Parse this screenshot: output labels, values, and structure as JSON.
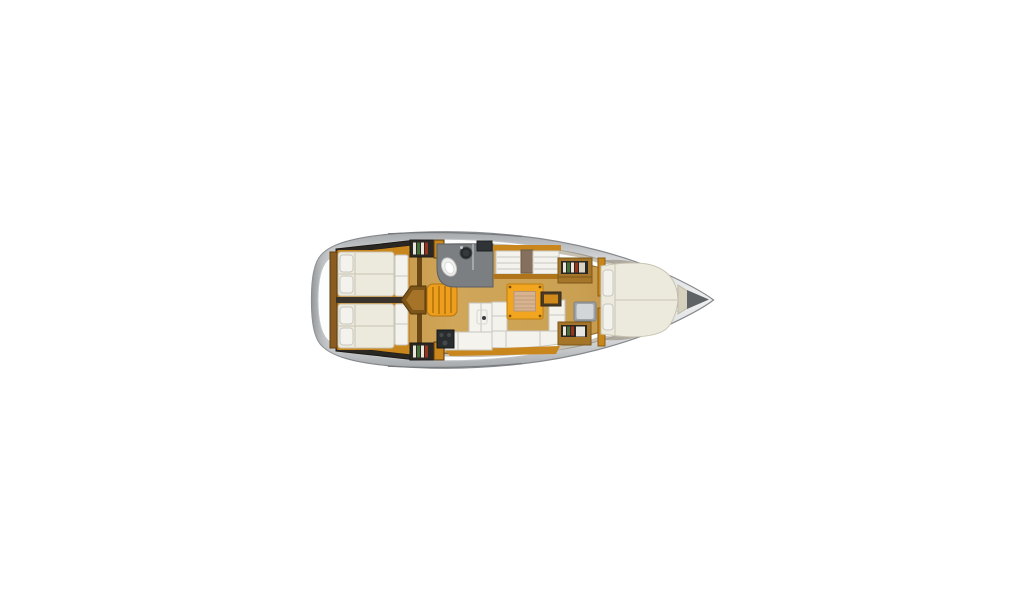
{
  "figure": {
    "kind": "yacht-interior-floor-plan",
    "orientation": "bow-right",
    "background": "#ffffff"
  },
  "colors": {
    "hull_edge": "#85898c",
    "hull_top": "#a6a9ac",
    "hull_mid": "#edeeee",
    "deck_white": "#fcfdfd",
    "deck_line": "#c2c5c7",
    "sheer_line": "#74787b",
    "floor_wood_edge": "#c1913f",
    "floor_wood_mid": "#d0a65a",
    "floor_wood_line": "#8a6526",
    "cabinet_orange": "#ed9e1d",
    "cabinet_orange_dark": "#c8861c",
    "trim_brown": "#8a5c22",
    "trim_brown_dark": "#5f3d10",
    "dark_trim": "#4a3e32",
    "divider_dark": "#3a332c",
    "cushion_white": "#f3f2ec",
    "cushion_line": "#c9c6c0",
    "bed_cream": "#eceadd",
    "bed_line": "#c8c4b2",
    "counter_gray": "#7b7f82",
    "counter_gray_dark": "#5b5e61",
    "appliance_dark": "#2a2d2f",
    "locker_dark": "#2b2722",
    "locker_edge": "#1c1916",
    "bench_divider": "#84705c",
    "table_orange": "#f2a61f",
    "table_edge": "#c07d10",
    "table_inlay": "#d7b391",
    "table_inlay_line": "#c5a07c",
    "seat_gray": "#9fa3a6",
    "seat_gray_light": "#d3d6d8",
    "bow_wedge": "#d6d1bf",
    "anchor_gray": "#5f6366",
    "interior_shadow": "#5a4520",
    "book_white": "#e9e6dc",
    "book_green": "#47713a",
    "book_red": "#99341f",
    "book_tan": "#d8d2c2"
  },
  "compartments": [
    {
      "id": "aft-cabin-port",
      "label": "aft double cabin port"
    },
    {
      "id": "aft-cabin-starboard",
      "label": "aft double cabin starboard"
    },
    {
      "id": "companionway",
      "label": "companionway steps"
    },
    {
      "id": "head",
      "label": "head with toilet and sink"
    },
    {
      "id": "galley",
      "label": "L-shaped galley with stove and sink"
    },
    {
      "id": "saloon",
      "label": "saloon with U-settee, table and facing seats"
    },
    {
      "id": "forward-cabin",
      "label": "forward V-berth cabin with seat and shelves"
    },
    {
      "id": "anchor-locker",
      "label": "bow anchor locker"
    }
  ]
}
